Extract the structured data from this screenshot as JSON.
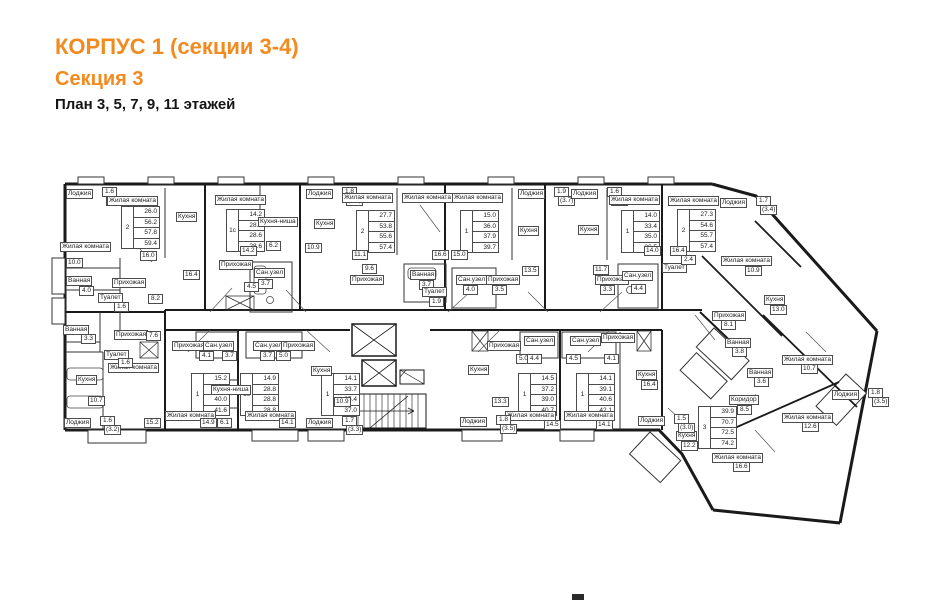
{
  "title": {
    "line1": "КОРПУС 1 (секции 3-4)",
    "line2": "Секция 3",
    "line3": "План 3, 5, 7, 9, 11 этажей"
  },
  "colors": {
    "accent": "#f28b1f",
    "wall": "#1a1a1a"
  },
  "plan": {
    "apartments": [
      {
        "id": "unit-1",
        "type": "2",
        "table": {
          "x": 121,
          "y": 206,
          "values": [
            "26.0",
            "56.2",
            "57.8",
            "59.4"
          ]
        },
        "rooms": [
          {
            "label": "Лоджия",
            "areas": [
              "1.6",
              "3.2"
            ],
            "x": 66,
            "y": 189
          },
          {
            "label": "Жилая комната",
            "area": "16.0",
            "x": 107,
            "y": 196,
            "ax": 140,
            "ay": 251
          },
          {
            "label": "Жилая комната",
            "area": "10.0",
            "x": 60,
            "y": 242,
            "ax": 66,
            "ay": 258
          },
          {
            "label": "Кухня",
            "area": "16.4",
            "x": 176,
            "y": 212,
            "ax": 183,
            "ay": 270
          },
          {
            "label": "Ванная",
            "area": "4.0",
            "x": 66,
            "y": 276,
            "ax": 79,
            "ay": 286
          },
          {
            "label": "Туалет",
            "area": "1.6",
            "x": 98,
            "y": 293,
            "ax": 114,
            "ay": 302
          },
          {
            "label": "Прихожая",
            "area": "8.2",
            "x": 112,
            "y": 278,
            "ax": 148,
            "ay": 294
          }
        ]
      },
      {
        "id": "unit-2",
        "type": "1с",
        "table": {
          "x": 226,
          "y": 209,
          "values": [
            "14.2",
            "28.6",
            "28.6",
            "28.6"
          ]
        },
        "rooms": [
          {
            "label": "Жилая комната",
            "area": "14.2",
            "x": 215,
            "y": 195,
            "ax": 240,
            "ay": 246
          },
          {
            "label": "Кухня-ниша",
            "area": "6.2",
            "x": 258,
            "y": 217,
            "ax": 266,
            "ay": 241
          },
          {
            "label": "Прихожая",
            "area": "4.5",
            "x": 219,
            "y": 260,
            "ax": 244,
            "ay": 282
          },
          {
            "label": "Сан.узел",
            "area": "3.7",
            "x": 254,
            "y": 268,
            "ax": 258,
            "ay": 279
          }
        ]
      },
      {
        "id": "unit-3",
        "type": "2",
        "table": {
          "x": 356,
          "y": 210,
          "values": [
            "27.7",
            "53.8",
            "55.6",
            "57.4"
          ]
        },
        "rooms": [
          {
            "label": "Лоджия",
            "areas": [
              "1.8",
              "3.6"
            ],
            "x": 306,
            "y": 189
          },
          {
            "label": "Жилая комната",
            "area": "11.1",
            "x": 342,
            "y": 193,
            "ax": 352,
            "ay": 250
          },
          {
            "label": "Жилая комната",
            "area": "16.6",
            "x": 402,
            "y": 193,
            "ax": 432,
            "ay": 250
          },
          {
            "label": "Кухня",
            "area": "10.9",
            "x": 314,
            "y": 219,
            "ax": 305,
            "ay": 243
          },
          {
            "label": "Прихожая",
            "area": "9.6",
            "x": 350,
            "y": 275,
            "ax": 362,
            "ay": 264
          },
          {
            "label": "Ванная",
            "area": "3.7",
            "x": 410,
            "y": 270,
            "ax": 419,
            "ay": 280
          },
          {
            "label": "Туалет",
            "area": "1.9",
            "x": 422,
            "y": 287,
            "ax": 429,
            "ay": 297
          }
        ]
      },
      {
        "id": "unit-4",
        "type": "1",
        "table": {
          "x": 460,
          "y": 210,
          "values": [
            "15.0",
            "36.0",
            "37.9",
            "39.7"
          ]
        },
        "rooms": [
          {
            "label": "Лоджия",
            "areas": [
              "1.9",
              "3.7"
            ],
            "x": 518,
            "y": 189
          },
          {
            "label": "Жилая комната",
            "area": "15.0",
            "x": 452,
            "y": 193,
            "ax": 451,
            "ay": 250
          },
          {
            "label": "Кухня",
            "area": "13.5",
            "x": 518,
            "y": 226,
            "ax": 522,
            "ay": 266
          },
          {
            "label": "Сан.узел",
            "area": "4.0",
            "x": 456,
            "y": 275,
            "ax": 463,
            "ay": 285
          },
          {
            "label": "Прихожая",
            "area": "3.5",
            "x": 486,
            "y": 275,
            "ax": 492,
            "ay": 285
          }
        ]
      },
      {
        "id": "unit-5",
        "type": "1",
        "table": {
          "x": 621,
          "y": 210,
          "values": [
            "14.0",
            "33.4",
            "35.0",
            "36.5"
          ]
        },
        "rooms": [
          {
            "label": "Лоджия",
            "areas": [
              "1.6",
              "3.1"
            ],
            "x": 571,
            "y": 189
          },
          {
            "label": "Жилая комната",
            "area": "14.0",
            "x": 609,
            "y": 195,
            "ax": 644,
            "ay": 246
          },
          {
            "label": "Кухня",
            "area": "11.7",
            "x": 578,
            "y": 225,
            "ax": 593,
            "ay": 265
          },
          {
            "label": "Прихожая",
            "area": "3.3",
            "x": 595,
            "y": 275,
            "ax": 600,
            "ay": 285
          },
          {
            "label": "Сан.узел",
            "area": "4.4",
            "x": 622,
            "y": 271,
            "ax": 631,
            "ay": 284
          }
        ]
      },
      {
        "id": "unit-6",
        "type": "2",
        "table": {
          "x": 677,
          "y": 209,
          "values": [
            "27.3",
            "54.6",
            "55.7",
            "57.4"
          ]
        },
        "rooms": [
          {
            "label": "Лоджия",
            "areas": [
              "1.7",
              "3.4"
            ],
            "x": 720,
            "y": 198
          },
          {
            "label": "Жилая комната",
            "area": "16.4",
            "x": 668,
            "y": 196,
            "ax": 670,
            "ay": 246
          },
          {
            "label": "Жилая комната",
            "area": "10.9",
            "x": 721,
            "y": 256,
            "ax": 745,
            "ay": 266
          },
          {
            "label": "Кухня",
            "area": "13.0",
            "x": 764,
            "y": 295,
            "ax": 770,
            "ay": 305
          },
          {
            "label": "Туалет",
            "area": "2.4",
            "x": 662,
            "y": 263,
            "ax": 681,
            "ay": 255
          },
          {
            "label": "Прихожая",
            "area": "8.1",
            "x": 712,
            "y": 311,
            "ax": 721,
            "ay": 320
          },
          {
            "label": "Ванная",
            "area": "3.8",
            "x": 725,
            "y": 338,
            "ax": 732,
            "ay": 347
          }
        ]
      },
      {
        "id": "unit-7",
        "type": "3",
        "table": {
          "x": 698,
          "y": 406,
          "values": [
            "39.9",
            "70.7",
            "72.5",
            "74.2"
          ]
        },
        "rooms": [
          {
            "label": "Коридор",
            "area": "8.5",
            "x": 729,
            "y": 395,
            "ax": 737,
            "ay": 405
          },
          {
            "label": "Кухня",
            "area": "12.2",
            "x": 676,
            "y": 431,
            "ax": 681,
            "ay": 441
          },
          {
            "label": "Жилая комната",
            "area": "16.6",
            "x": 712,
            "y": 453,
            "ax": 733,
            "ay": 462
          },
          {
            "label": "Жилая комната",
            "area": "12.6",
            "x": 782,
            "y": 413,
            "ax": 802,
            "ay": 422
          },
          {
            "label": "Жилая комната",
            "area": "10.7",
            "x": 782,
            "y": 355,
            "ax": 801,
            "ay": 364
          },
          {
            "label": "Ванная",
            "area": "3.6",
            "x": 747,
            "y": 368,
            "ax": 754,
            "ay": 377
          },
          {
            "label": "Лоджия",
            "areas": [
              "1.8",
              "3.5"
            ],
            "x": 832,
            "y": 390
          }
        ]
      },
      {
        "id": "unit-8",
        "type": "1",
        "table": {
          "x": 191,
          "y": 373,
          "values": [
            "15.2",
            "38.4",
            "40.0",
            "41.6"
          ]
        },
        "rooms": [
          {
            "label": "Жилая комната",
            "area": "15.2",
            "x": 108,
            "y": 363,
            "ax": 144,
            "ay": 418
          },
          {
            "label": "Кухня",
            "area": "10.7",
            "x": 76,
            "y": 375,
            "ax": 88,
            "ay": 396
          },
          {
            "label": "Ванная",
            "area": "3.3",
            "x": 63,
            "y": 325,
            "ax": 81,
            "ay": 334
          },
          {
            "label": "Туалет",
            "area": "1.6",
            "x": 104,
            "y": 350,
            "ax": 118,
            "ay": 358
          },
          {
            "label": "Прихожая",
            "area": "7.6",
            "x": 114,
            "y": 330,
            "ax": 146,
            "ay": 331
          },
          {
            "label": "Лоджия",
            "areas": [
              "1.6",
              "3.2"
            ],
            "x": 64,
            "y": 418
          }
        ]
      },
      {
        "id": "unit-9",
        "type": "1с",
        "table": {
          "x": 240,
          "y": 373,
          "values": [
            "14.9",
            "28.8",
            "28.8",
            "28.8"
          ]
        },
        "rooms": [
          {
            "label": "Жилая комната",
            "area": "14.9",
            "x": 165,
            "y": 411,
            "ax": 200,
            "ay": 418
          },
          {
            "label": "Кухня-ниша",
            "area": "6.1",
            "x": 211,
            "y": 385,
            "ax": 217,
            "ay": 418
          },
          {
            "label": "Прихожая",
            "area": "4.1",
            "x": 172,
            "y": 341,
            "ax": 199,
            "ay": 351
          },
          {
            "label": "Сан.узел",
            "area": "3.7",
            "x": 203,
            "y": 341,
            "ax": 222,
            "ay": 351
          }
        ]
      },
      {
        "id": "unit-10",
        "type": "1",
        "table": {
          "x": 321,
          "y": 373,
          "values": [
            "14.1",
            "33.7",
            "35.4",
            "37.0"
          ]
        },
        "rooms": [
          {
            "label": "Жилая комната",
            "area": "14.1",
            "x": 245,
            "y": 411,
            "ax": 279,
            "ay": 418
          },
          {
            "label": "Кухня",
            "area": "10.9",
            "x": 311,
            "y": 366,
            "ax": 334,
            "ay": 397
          },
          {
            "label": "Сан.узел",
            "area": "3.7",
            "x": 253,
            "y": 341,
            "ax": 260,
            "ay": 351
          },
          {
            "label": "Прихожая",
            "area": "5.0",
            "x": 281,
            "y": 341,
            "ax": 276,
            "ay": 351
          },
          {
            "label": "Лоджия",
            "areas": [
              "1.7",
              "3.3"
            ],
            "x": 306,
            "y": 418
          }
        ]
      },
      {
        "id": "unit-11",
        "type": "1",
        "table": {
          "x": 518,
          "y": 373,
          "values": [
            "14.5",
            "37.2",
            "39.0",
            "40.7"
          ]
        },
        "rooms": [
          {
            "label": "Жилая комната",
            "area": "14.5",
            "x": 505,
            "y": 411,
            "ax": 544,
            "ay": 420
          },
          {
            "label": "Кухня",
            "area": "13.3",
            "x": 468,
            "y": 365,
            "ax": 492,
            "ay": 397
          },
          {
            "label": "Прихожая",
            "area": "5.0",
            "x": 487,
            "y": 341,
            "ax": 516,
            "ay": 354
          },
          {
            "label": "Сан.узел",
            "area": "4.4",
            "x": 524,
            "y": 336,
            "ax": 527,
            "ay": 354
          },
          {
            "label": "Лоджия",
            "areas": [
              "1.8",
              "3.5"
            ],
            "x": 460,
            "y": 417
          }
        ]
      },
      {
        "id": "unit-12",
        "type": "1",
        "table": {
          "x": 576,
          "y": 373,
          "values": [
            "14.1",
            "39.1",
            "40.6",
            "42.1"
          ]
        },
        "rooms": [
          {
            "label": "Жилая комната",
            "area": "14.1",
            "x": 564,
            "y": 411,
            "ax": 596,
            "ay": 420
          },
          {
            "label": "Кухня",
            "area": "16.4",
            "x": 636,
            "y": 370,
            "ax": 641,
            "ay": 380
          },
          {
            "label": "Сан.узел",
            "area": "4.5",
            "x": 570,
            "y": 336,
            "ax": 566,
            "ay": 354
          },
          {
            "label": "Прихожая",
            "area": "4.1",
            "x": 601,
            "y": 333,
            "ax": 604,
            "ay": 354
          },
          {
            "label": "Лоджия",
            "areas": [
              "1.5",
              "3.0"
            ],
            "x": 638,
            "y": 416
          }
        ]
      }
    ]
  }
}
